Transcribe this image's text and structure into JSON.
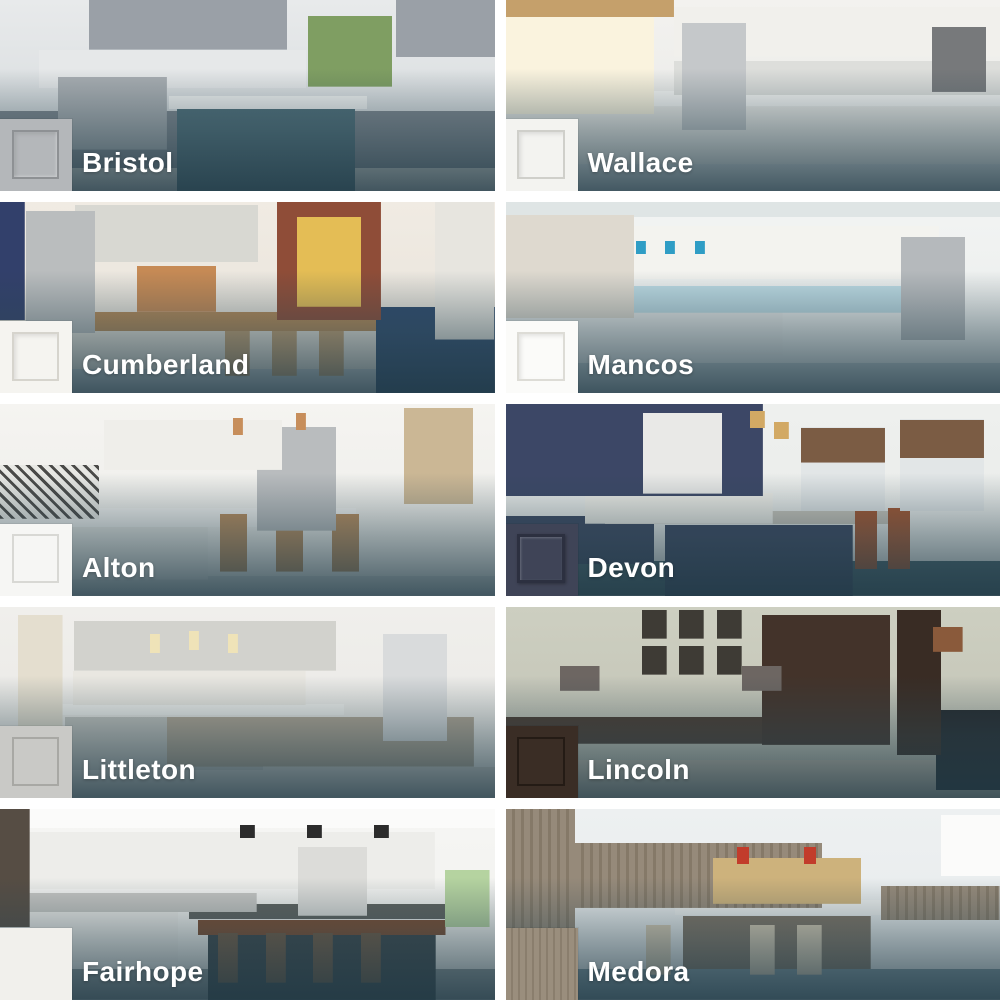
{
  "page": {
    "background": "#ffffff"
  },
  "overlay": {
    "scrim_top": "rgba(43,69,80,0)",
    "scrim_mid": "rgba(43,69,80,0.45)",
    "scrim_bottom": "rgba(33,58,70,0.82)"
  },
  "label": {
    "color": "#ffffff"
  },
  "tiles": [
    {
      "name": "Bristol",
      "photo": "gray shaker kitchen with slate-teal island and garden window",
      "swatch": {
        "color": "#b4b7ba",
        "line": "#8e9194",
        "panel": "shaker"
      },
      "scene": {
        "wall": "#e8eaeb",
        "wall2": "#d2d7da",
        "cab": "#9aa0a7",
        "cab2": "#7e868e",
        "splash": "#e6e8e9",
        "counter": "#f4f5f4",
        "island": "#4e6e79",
        "appliance": "#a9aeb2",
        "accent": "#7f9e62",
        "floor": "#d8d5d0"
      }
    },
    {
      "name": "Wallace",
      "photo": "bright white kitchen with sunny window, brass faucet and wall oven",
      "swatch": {
        "color": "#f3f3f0",
        "line": "#cfcfca",
        "panel": "shaker"
      },
      "scene": {
        "wall": "#f3f2ef",
        "wall2": "#e7e8e6",
        "cab": "#f1f0ec",
        "cab2": "#ecebe7",
        "splash": "#dddedb",
        "counter": "#f7f7f5",
        "appliance": "#c5c8ca",
        "appliance2": "#77797b",
        "accent": "#faf3de",
        "accent2": "#c5a06b",
        "floor": "#dfe3e4"
      }
    },
    {
      "name": "Cumberland",
      "photo": "light gray kitchen with brick windows, wood bar, tan stools and navy island",
      "swatch": {
        "color": "#f5f4f0",
        "line": "#d6d4cd",
        "panel": "shaker"
      },
      "scene": {
        "wall": "#f0ebe3",
        "wall2": "#e7e2d9",
        "cab": "#d8d8d2",
        "appliance": "#babdbe",
        "accent": "#c68a55",
        "accent2": "#32406b",
        "brick": "#8f4d38",
        "window": "#e4bd55",
        "shelf": "#e7e5df",
        "wood": "#b78a57",
        "stool": "#c7a273",
        "island": "#2e4a6d",
        "floor": "#c9d0d2"
      }
    },
    {
      "name": "Mancos",
      "photo": "white coastal kitchen with blue glass backsplash and teal pendants",
      "swatch": {
        "color": "#fbfbf9",
        "line": "#dddcd6",
        "panel": "shaker"
      },
      "scene": {
        "wall": "#f2f4f3",
        "wall2": "#e8ebea",
        "ceiling": "#dfe5e5",
        "curtain": "#ded9cf",
        "cab": "#f3f3ef",
        "splash": "#bddbe4",
        "appliance": "#b5b9bc",
        "island": "#e9ebea",
        "accent": "#2f9dc5",
        "floor": "#c5cfd3"
      }
    },
    {
      "name": "Alton",
      "photo": "white kitchen with black-and-white tile, copper pendants and wood stools",
      "swatch": {
        "color": "#f6f6f4",
        "line": "#d8d8d4",
        "panel": "outline"
      },
      "scene": {
        "wall": "#f5f4f1",
        "wall2": "#ebebe7",
        "cab": "#efeeea",
        "cab2": "#e9e9e5",
        "tile1": "#4a4a48",
        "tile2": "#e8e8e4",
        "appliance": "#b9bcbe",
        "accent": "#c78e5b",
        "accent2": "#cbb795",
        "stool": "#b98c5c",
        "counter": "#f3f3f1",
        "floor": "#d7dad9"
      }
    },
    {
      "name": "Devon",
      "photo": "navy blue kitchen with white hood, subway tile, woven blinds and rust stools",
      "swatch": {
        "color": "#3f4457",
        "line": "#2c3040",
        "panel": "raised"
      },
      "scene": {
        "wall": "#eef0ee",
        "wall2": "#e8eae8",
        "cab": "#3c4766",
        "cab2": "#39455f",
        "hood": "#e9e9e7",
        "splash": "#efeee8",
        "window": "#e2e6e7",
        "blind": "#7b5c44",
        "accent": "#d2a964",
        "counter": "#c9c5bb",
        "island": "#38445e",
        "stool": "#a3542e",
        "floor": "#43606a"
      }
    },
    {
      "name": "Littleton",
      "photo": "light gray kitchen with glass pendants, farmhouse table and white fridge",
      "swatch": {
        "color": "#c9c9c6",
        "line": "#a8a8a4",
        "panel": "outline"
      },
      "scene": {
        "wall": "#f0efec",
        "wall2": "#e8e7e3",
        "door": "#e4decf",
        "cab": "#d2d2cd",
        "cab2": "#c5c5c0",
        "splash": "#e9e7e1",
        "appliance": "#d9dbdc",
        "accent": "#efe3b8",
        "wood": "#b3a795",
        "counter": "#f2f2ef",
        "floor": "#d6d3cd"
      }
    },
    {
      "name": "Lincoln",
      "photo": "espresso home office with gallery frames, desk lamps and leather chair",
      "swatch": {
        "color": "#3a2d25",
        "line": "#241b15",
        "panel": "outline"
      },
      "scene": {
        "wall": "#cdcfc1",
        "wall2": "#c0c0b2",
        "frame": "#3e3b35",
        "shade": "#6d6662",
        "accent": "#8a5a3b",
        "cab": "#43332a",
        "cab2": "#392c24",
        "wood": "#4a392e",
        "chair": "#23272b",
        "floor": "#cec4b3"
      }
    },
    {
      "name": "Fairhope",
      "photo": "modern flat-panel white kitchen with black pendants and walnut island",
      "swatch": {
        "color": "#f1f0ec",
        "line": "#d6d5d0",
        "panel": "slab"
      },
      "scene": {
        "wall": "#f6f6f4",
        "wall2": "#efefec",
        "ceiling": "#fbfbfa",
        "shelf": "#564d44",
        "cab": "#ededea",
        "cab2": "#eeedea",
        "splash": "#c6c6c3",
        "appliance": "#dcdcd9",
        "accent": "#b5d3a0",
        "accent2": "#2c2c2c",
        "counter": "#5e615e",
        "wood": "#7b4b2f",
        "island": "#374247",
        "stool": "#6e5742",
        "floor": "#90999b"
      }
    },
    {
      "name": "Medora",
      "photo": "driftwood woodgrain kitchen with yellow brick, red pendants and cream stools",
      "swatch": {
        "color": "#9a8e7d",
        "line": "#8a7e6d",
        "panel": "wood"
      },
      "scene": {
        "wall": "#edf0f1",
        "wall2": "#e6eaeb",
        "wood": "#968a7a",
        "wood2": "#857968",
        "brick": "#cdb27c",
        "window": "#fbfbfa",
        "counter": "#eff1f0",
        "island": "#7e7365",
        "stool": "#d8cbb4",
        "accent": "#c23c2b",
        "floor": "#7f97a1"
      }
    }
  ]
}
